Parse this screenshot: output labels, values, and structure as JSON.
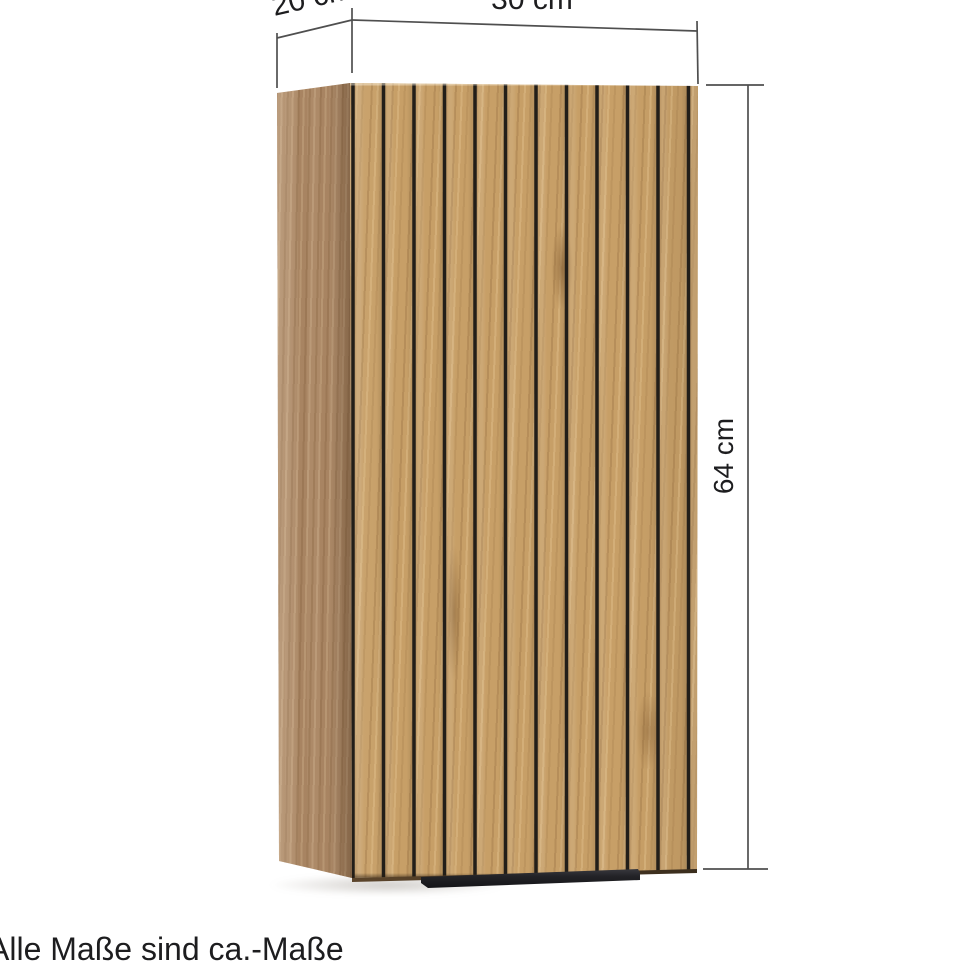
{
  "diagram": {
    "dimensions": {
      "depth": {
        "label": "20 cm"
      },
      "width": {
        "label": "30 cm"
      },
      "height": {
        "label": "64 cm"
      }
    },
    "note": "Alle Maße sind ca.-Maße",
    "colors": {
      "wood_front": "#c79f67",
      "wood_side": "#ad8a68",
      "slat_groove": "#221e19",
      "dimension_line": "#4f4f4f",
      "text": "#1d1d1f",
      "background": "#ffffff"
    }
  }
}
